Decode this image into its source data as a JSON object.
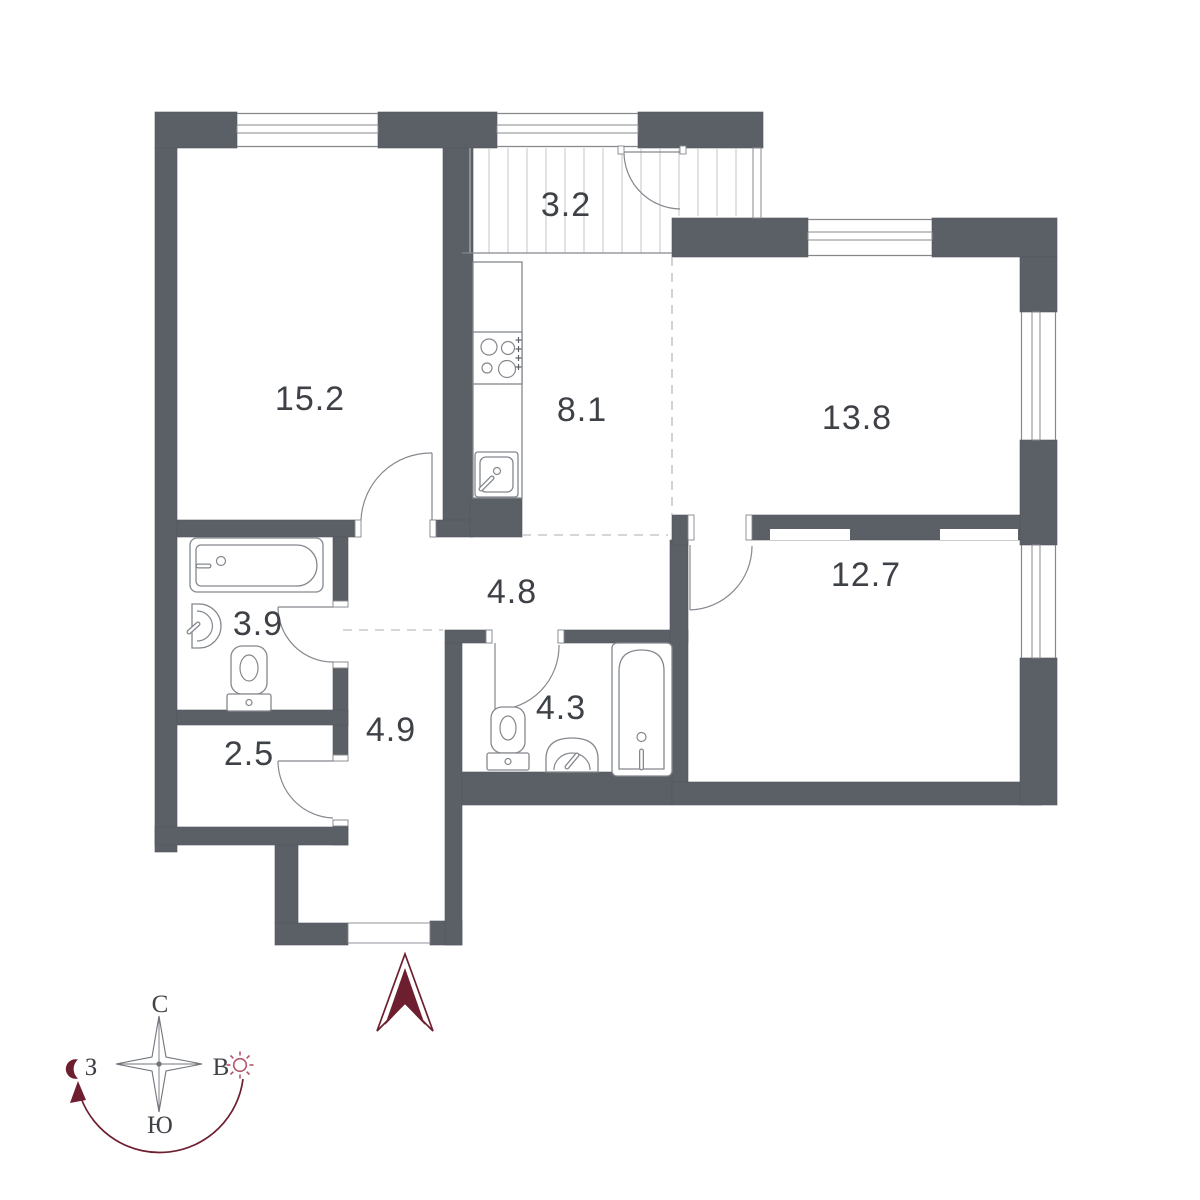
{
  "title": "apartment-floor-plan",
  "colors": {
    "wall": "#5b5f66",
    "line": "#84888d",
    "dash": "#c6c8ca",
    "text": "#3e4247",
    "accent": "#6d1f2f",
    "sun": "#b4566b",
    "hatch": "#c2c5c7"
  },
  "rooms": [
    {
      "name": "living-room",
      "area": "15.2"
    },
    {
      "name": "balcony",
      "area": "3.2"
    },
    {
      "name": "kitchen",
      "area": "8.1"
    },
    {
      "name": "room-top-right",
      "area": "13.8"
    },
    {
      "name": "corridor",
      "area": "4.8"
    },
    {
      "name": "bathroom",
      "area": "3.9"
    },
    {
      "name": "storage",
      "area": "2.5"
    },
    {
      "name": "hallway",
      "area": "4.9"
    },
    {
      "name": "wc",
      "area": "4.3"
    },
    {
      "name": "bedroom",
      "area": "12.7"
    }
  ],
  "compass": {
    "north": "С",
    "south": "Ю",
    "west": "З",
    "east": "В"
  },
  "icons": {
    "entrance": "entrance-arrow",
    "moon": "crescent-moon",
    "sun": "sun",
    "fixtures": [
      "stove-icon",
      "kitchen-sink-icon",
      "bathtub-icon",
      "wash-basin-icon",
      "toilet-icon"
    ]
  }
}
